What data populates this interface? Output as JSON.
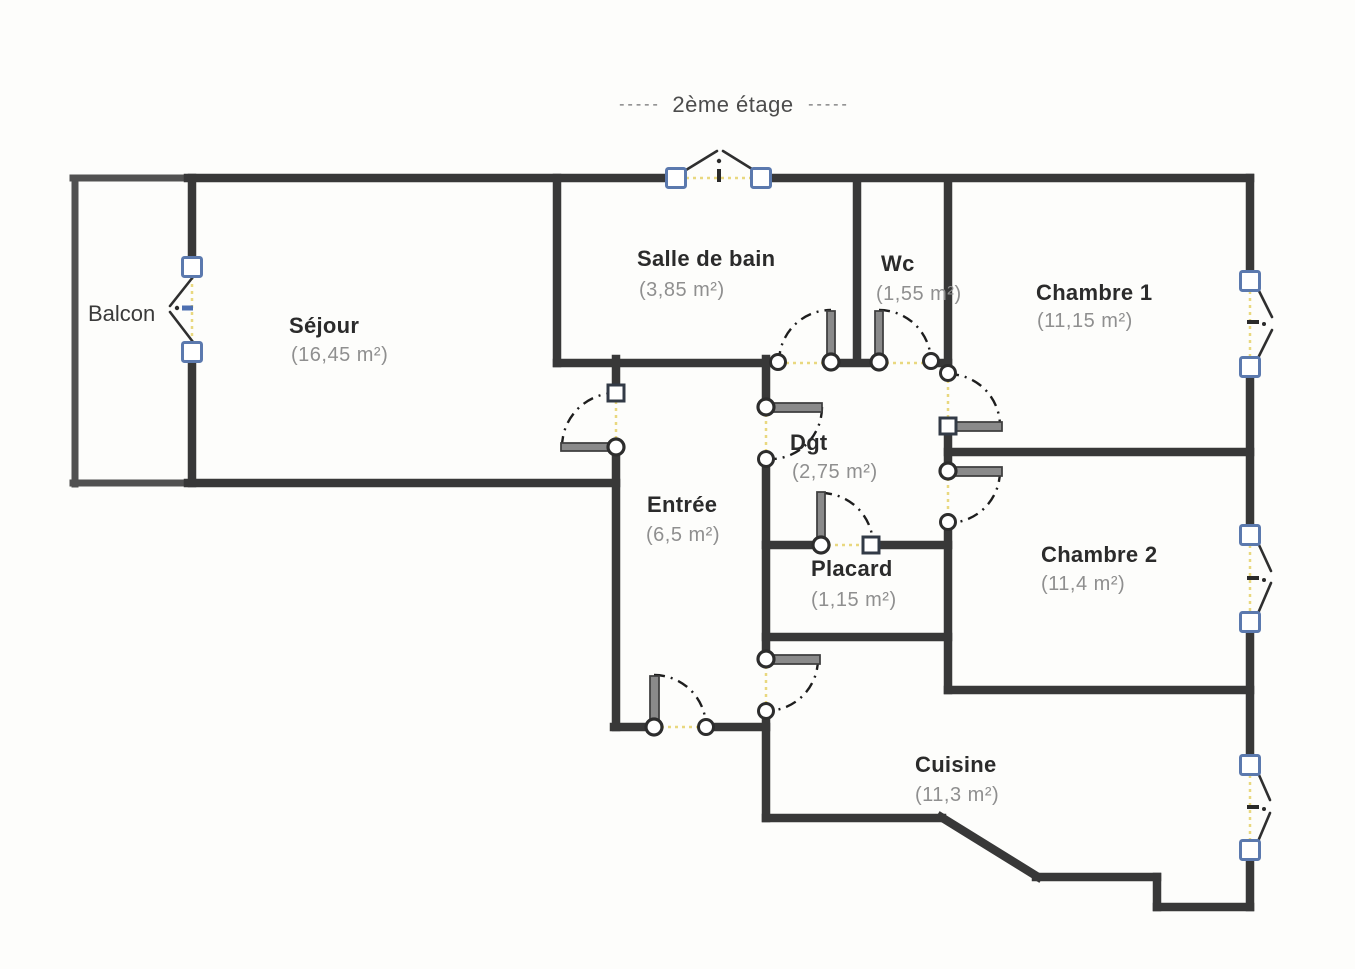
{
  "title": {
    "dashes_left": "-----",
    "text": "2ème étage",
    "dashes_right": "-----"
  },
  "rooms": {
    "balcon": {
      "name": "Balcon"
    },
    "sejour": {
      "name": "Séjour",
      "area": "(16,45 m²)"
    },
    "salle_de_bain": {
      "name": "Salle de bain",
      "area": "(3,85 m²)"
    },
    "wc": {
      "name": "Wc",
      "area": "(1,55 m²)"
    },
    "chambre1": {
      "name": "Chambre 1",
      "area": "(11,15 m²)"
    },
    "dgt": {
      "name": "Dgt",
      "area": "(2,75 m²)"
    },
    "entree": {
      "name": "Entrée",
      "area": "(6,5 m²)"
    },
    "placard": {
      "name": "Placard",
      "area": "(1,15 m²)"
    },
    "chambre2": {
      "name": "Chambre 2",
      "area": "(11,4 m²)"
    },
    "cuisine": {
      "name": "Cuisine",
      "area": "(11,3 m²)"
    }
  },
  "colors": {
    "wall": "#383838",
    "balcony_wall": "#515151",
    "door_leaf": "#8a8a8a",
    "door_arc": "#1e1e1e",
    "window_frame": "#5b79ae",
    "opening_guide": "#e9d87f",
    "room_label": "#2b2b2b",
    "area_label": "#8f8f8f",
    "title": "#4c4c4c"
  }
}
